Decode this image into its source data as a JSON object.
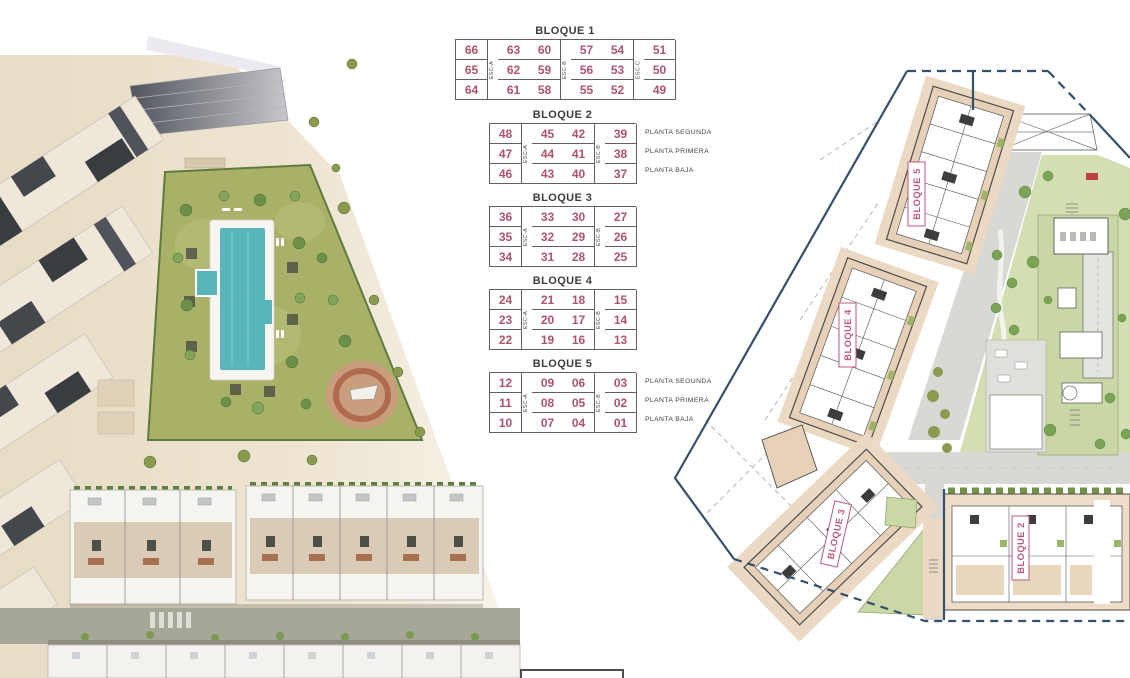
{
  "legend_tables": [
    {
      "title": "BLOQUE 1",
      "pattern": [
        "n",
        "e",
        "n",
        "n",
        "e",
        "n",
        "n",
        "e",
        "n"
      ],
      "esc": [
        "ESC-A",
        "ESC-B",
        "ESC-C"
      ],
      "rows": [
        [
          "66",
          "63",
          "60",
          "57",
          "54",
          "51"
        ],
        [
          "65",
          "62",
          "59",
          "56",
          "53",
          "50"
        ],
        [
          "64",
          "61",
          "58",
          "55",
          "52",
          "49"
        ]
      ],
      "floors": []
    },
    {
      "title": "BLOQUE 2",
      "pattern": [
        "n",
        "e",
        "n",
        "n",
        "e",
        "n"
      ],
      "esc": [
        "ESC-A",
        "ESC-B"
      ],
      "rows": [
        [
          "48",
          "45",
          "42",
          "39"
        ],
        [
          "47",
          "44",
          "41",
          "38"
        ],
        [
          "46",
          "43",
          "40",
          "37"
        ]
      ],
      "floors": [
        "PLANTA SEGUNDA",
        "PLANTA PRIMERA",
        "PLANTA BAJA"
      ]
    },
    {
      "title": "BLOQUE 3",
      "pattern": [
        "n",
        "e",
        "n",
        "n",
        "e",
        "n"
      ],
      "esc": [
        "ESC-A",
        "ESC-B"
      ],
      "rows": [
        [
          "36",
          "33",
          "30",
          "27"
        ],
        [
          "35",
          "32",
          "29",
          "26"
        ],
        [
          "34",
          "31",
          "28",
          "25"
        ]
      ],
      "floors": []
    },
    {
      "title": "BLOQUE 4",
      "pattern": [
        "n",
        "e",
        "n",
        "n",
        "e",
        "n"
      ],
      "esc": [
        "ESC-A",
        "ESC-B"
      ],
      "rows": [
        [
          "24",
          "21",
          "18",
          "15"
        ],
        [
          "23",
          "20",
          "17",
          "14"
        ],
        [
          "22",
          "19",
          "16",
          "13"
        ]
      ],
      "floors": []
    },
    {
      "title": "BLOQUE 5",
      "pattern": [
        "n",
        "e",
        "n",
        "n",
        "e",
        "n"
      ],
      "esc": [
        "ESC-A",
        "ESC-B"
      ],
      "rows": [
        [
          "12",
          "09",
          "06",
          "03"
        ],
        [
          "11",
          "08",
          "05",
          "02"
        ],
        [
          "10",
          "07",
          "04",
          "01"
        ]
      ],
      "floors": [
        "PLANTA SEGUNDA",
        "PLANTA PRIMERA",
        "PLANTA BAJA"
      ]
    }
  ],
  "site_plan": {
    "block_labels": [
      "BLOQUE 5",
      "BLOQUE 4",
      "BLOQUE 3",
      "BLOQUE 2"
    ]
  },
  "colors": {
    "unit_number": "#b0536b",
    "block_label": "#c2597a",
    "boundary_navy": "#35506e",
    "pool_teal": "#58b6ba",
    "garden_green": "#a9b068",
    "plan_green": "#d3deb2",
    "building_beige": "#e7d0b8",
    "road_gray": "#d8d8d5"
  }
}
